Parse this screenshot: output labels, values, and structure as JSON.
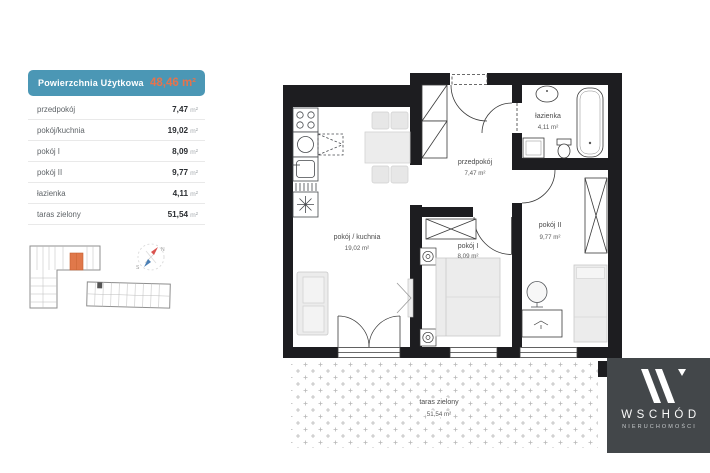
{
  "area_table": {
    "title": "Powierzchnia Użytkowa",
    "total": "48,46 m²",
    "rows": [
      {
        "label": "przedpokój",
        "value": "7,47",
        "unit": "m²"
      },
      {
        "label": "pokój/kuchnia",
        "value": "19,02",
        "unit": "m²"
      },
      {
        "label": "pokój I",
        "value": "8,09",
        "unit": "m²"
      },
      {
        "label": "pokój II",
        "value": "9,77",
        "unit": "m²"
      },
      {
        "label": "łazienka",
        "value": "4,11",
        "unit": "m²"
      },
      {
        "label": "taras zielony",
        "value": "51,54",
        "unit": "m²"
      }
    ]
  },
  "floor_plan": {
    "rooms": [
      {
        "name": "przedpokój",
        "area": "7,47 m²"
      },
      {
        "name": "pokój / kuchnia",
        "area": "19,02 m²"
      },
      {
        "name": "pokój I",
        "area": "8,09 m²"
      },
      {
        "name": "pokój II",
        "area": "9,77 m²"
      },
      {
        "name": "łazienka",
        "area": "4,11 m²"
      },
      {
        "name": "taras zielony",
        "area": "51,54 m²"
      }
    ]
  },
  "site_map": {
    "compass": {
      "north": "N",
      "south": "S"
    }
  },
  "logo": {
    "brand": "WSCHÓD",
    "subtitle": "NIERUCHOMOŚCI"
  },
  "colors": {
    "header_teal": "#4b97b5",
    "accent_orange": "#e6734c",
    "wall_black": "#1d1d20",
    "logo_background": "#43474a",
    "highlight_unit_orange": "#e0784a"
  }
}
